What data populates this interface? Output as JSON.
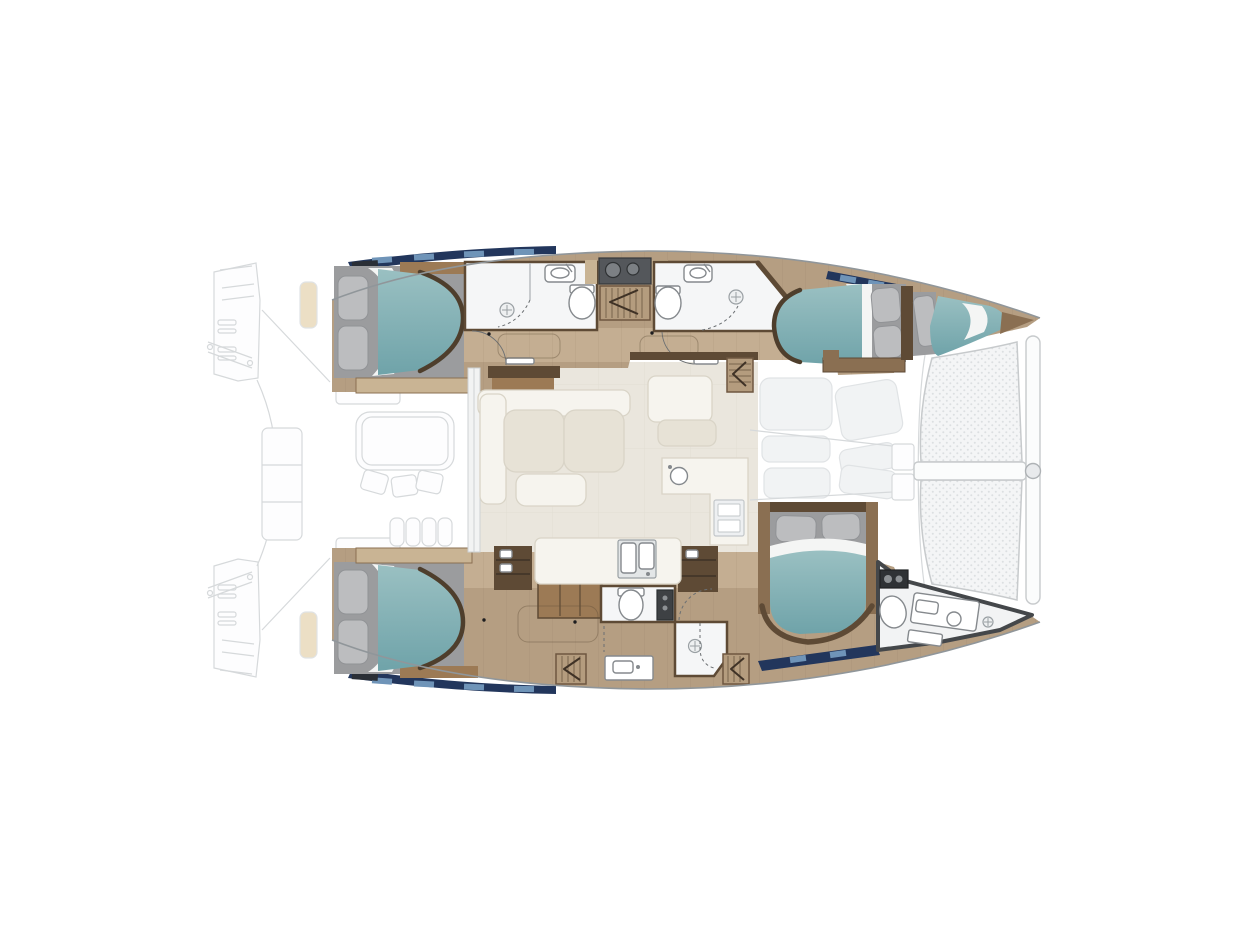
{
  "page": {
    "title": "Catamaran yacht deck plan — top-down 4-cabin layout",
    "background": "#ffffff",
    "orientation": {
      "bow": "right",
      "stern": "left"
    }
  },
  "palette": {
    "navy": "#22365c",
    "navyLight": "#6f94b8",
    "teal": "#86b2b6",
    "sheet": "#f4f5f4",
    "plat": "#9b9c9e",
    "pillow": "#bcbdbf",
    "pillowEdge": "#919396",
    "woodFloor": "#b59e82",
    "woodFloorLight": "#c4ae92",
    "woodDark": "#5e4a35",
    "woodMid": "#8a6f52",
    "woodWarm": "#9c7a55",
    "woodTan": "#c9b494",
    "bathFloor": "#f5f6f7",
    "fixtureStroke": "#85898d",
    "darkUnit": "#3e4144",
    "ghostStroke": "#d6d9db",
    "ghostFill": "#fdfdfe",
    "hullStroke": "#90969a",
    "salonFloor": "#eae6dd",
    "cream": "#f6f4ee",
    "creamShade": "#e7e2d6",
    "creamStroke": "#d9d4c7",
    "trampStroke": "#c7cacc",
    "counterDark": "#54575b",
    "cushionTan": "#ecdfc5"
  },
  "plan": {
    "port_hull_top": {
      "rooms": [
        "aft double cabin with teal berth and two pillows",
        "aft head: shower stall, washbasin, toilet",
        "companionway stairs with down arrow and wet-bar counter",
        "forward head: toilet, washbasin, shower",
        "forward double cabin with teal berth and two pillows",
        "forepeak berth with single pillow"
      ]
    },
    "starboard_hull_bottom": {
      "rooms": [
        "aft double cabin with teal berth and two pillows",
        "dresser and open shelving units",
        "day head: toilet and tall dark vanity unit",
        "shower room with drain",
        "washbasin vanity, two louvered steps",
        "forward island-berth cabin with two pillows",
        "bow head: windlass box, toilet, vanity with basin, shower drain"
      ]
    },
    "bridgedeck_salon": {
      "items": [
        "L-shaped cream sofa with ottoman",
        "forward lounge seat",
        "galley L-counter with round sink and appliance",
        "galley island with double sink",
        "sliding glass door to cockpit"
      ]
    },
    "exterior_ghosted": {
      "items": [
        "port and starboard transom swim platforms with cleats",
        "transom step cushions",
        "aft cockpit table with three chairs and bench seating",
        "davit lines",
        "foredeck sun pads and anchor lockers",
        "twin bow trampolines with centre crossbar",
        "forestay chainplate fitting"
      ]
    }
  }
}
